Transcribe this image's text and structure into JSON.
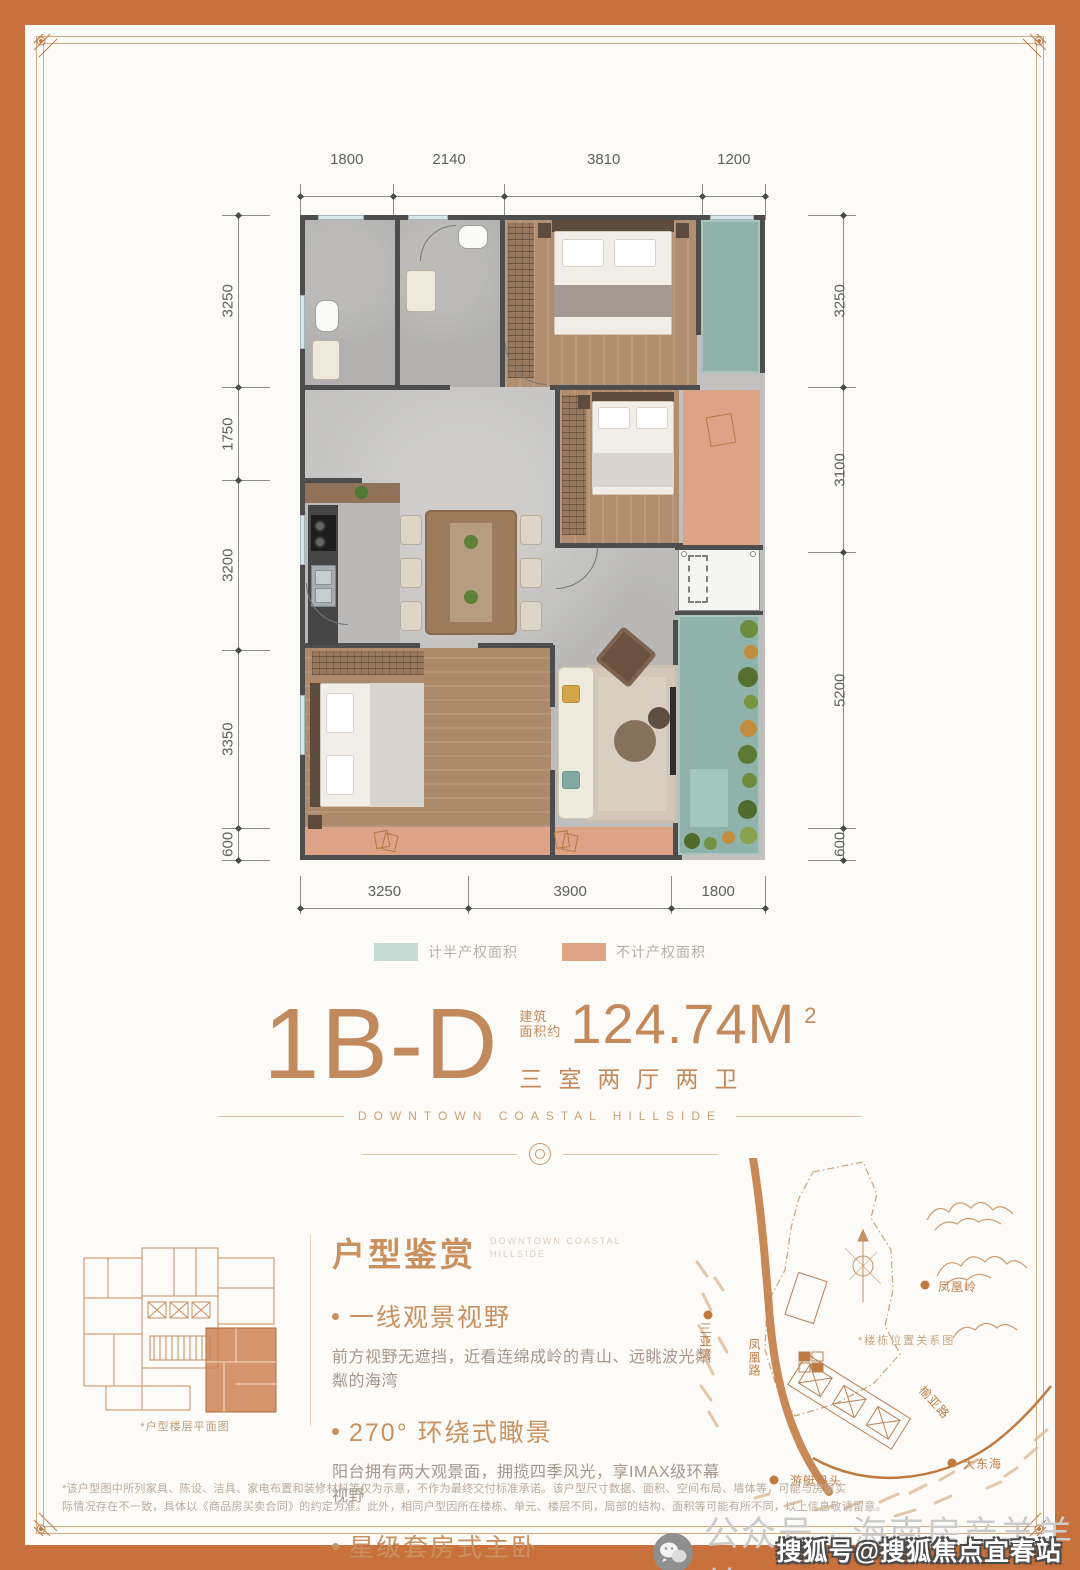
{
  "floor_plan": {
    "dimensions": {
      "top": [
        1800,
        2140,
        3810,
        1200
      ],
      "left": [
        3250,
        1750,
        3200,
        3350,
        600
      ],
      "right": [
        3250,
        3100,
        5200,
        600
      ],
      "bottom": [
        3250,
        3900,
        1800
      ]
    },
    "ac_label": "A/C",
    "legend": [
      {
        "label": "计半产权面积",
        "color": "#c5dbd4"
      },
      {
        "label": "不计产权面积",
        "color": "#dfa587"
      }
    ]
  },
  "title": {
    "code": "1B-D",
    "area_prefix": [
      "建筑",
      "面积约"
    ],
    "area_value": "124.74M",
    "area_sup": "2",
    "rooms": "三室两厅两卫",
    "en_tagline": "DOWNTOWN COASTAL HILLSIDE"
  },
  "features": {
    "heading": "户型鉴赏",
    "en_line1": "DOWNTOWN COASTAL",
    "en_line2": "HILLSIDE",
    "items": [
      {
        "title": "一线观景视野",
        "desc": "前方视野无遮挡，近看连绵成岭的青山、远眺波光粼粼的海湾"
      },
      {
        "title": "270° 环绕式瞰景",
        "desc": "阳台拥有两大观景面，拥揽四季风光，享IMAX级环幕视野"
      },
      {
        "title": "星级套房式主卧",
        "desc": "主卧堪称星级酒店套房配置，自带观景阳台，自成私密世界"
      }
    ]
  },
  "floor_plate": {
    "caption": "*户型楼层平面图"
  },
  "map": {
    "caption": "*楼栋位置关系图",
    "labels": [
      {
        "text": "凤凰岭"
      },
      {
        "text": "凤凰路"
      },
      {
        "text": "榆亚路"
      },
      {
        "text": "游艇码头"
      },
      {
        "text": "大东海"
      },
      {
        "text": "三亚湾"
      }
    ]
  },
  "footer": {
    "disclaimer1": "*该户型图中所列家具、陈设、洁具、家电布置和装修材料等仅为示意，不作为最终交付标准承诺。该户型尺寸数据、面积、空间布局、墙体等，可能与房屋实",
    "disclaimer2": "际情况存在不一致，具体以《商品房买卖合同》的约定为准。此外，相同户型因所在楼栋、单元、楼层不同，局部的结构、面积等可能有所不同，以上信息敬请留意。",
    "wechat": "公众号 · 海南房产羊羊羊",
    "watermark": "搜狐号@搜狐焦点宜春站"
  }
}
